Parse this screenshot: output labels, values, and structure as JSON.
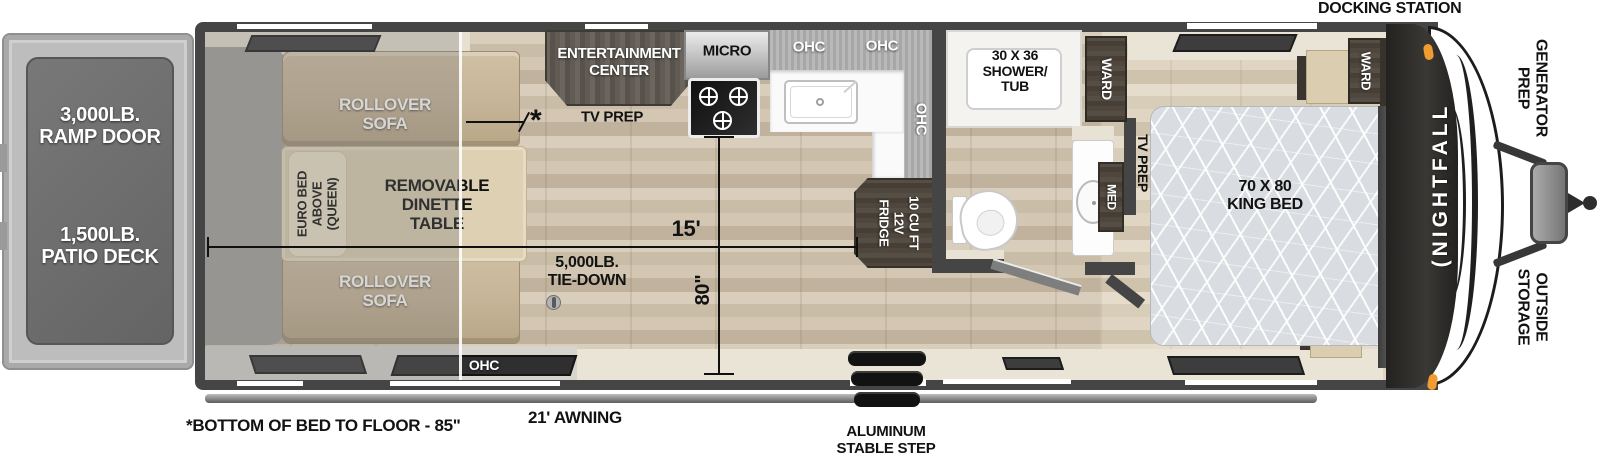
{
  "colors": {
    "wall": "#454545",
    "floor_wood": "#cfc4b0",
    "cabinet_dark": "#57524a",
    "sofa_tan": "#c6b497",
    "marker_amber": "#f29b30",
    "cream": "#e9e4d6"
  },
  "exterior": {
    "docking_station": "DOCKING STATION",
    "generator_prep": [
      "GENERATOR",
      "PREP"
    ],
    "outside_storage": [
      "OUTSIDE",
      "STORAGE"
    ],
    "brand_mark": "(",
    "brand": "NIGHTFALL",
    "awning": "21' AWNING",
    "step": [
      "ALUMINUM",
      "STABLE STEP"
    ],
    "bed_height_note": "*BOTTOM OF BED TO FLOOR - 85\""
  },
  "ramp": {
    "ramp_door": [
      "3,000LB.",
      "RAMP DOOR"
    ],
    "patio_deck": [
      "1,500LB.",
      "PATIO DECK"
    ]
  },
  "garage": {
    "sofa_top": [
      "ROLLOVER",
      "SOFA"
    ],
    "sofa_bottom": [
      "ROLLOVER",
      "SOFA"
    ],
    "euro_bed": [
      "EURO BED",
      "ABOVE",
      "(QUEEN)"
    ],
    "dinette": [
      "REMOVABLE",
      "DINETTE",
      "TABLE"
    ],
    "tie_down": [
      "5,000LB.",
      "TIE-DOWN"
    ],
    "ohc": "OHC"
  },
  "kitchen": {
    "entertainment_center": [
      "ENTERTAINMENT",
      "CENTER"
    ],
    "tv_prep": "TV PREP",
    "micro": "MICRO",
    "ohc_left": "OHC",
    "ohc_right": "OHC",
    "ohc_side": "OHC",
    "fridge": [
      "10 CU FT",
      "12V",
      "FRIDGE"
    ]
  },
  "bath": {
    "shower": [
      "30 X 36",
      "SHOWER/",
      "TUB"
    ],
    "ward": "WARD",
    "med": "MED"
  },
  "bedroom": {
    "tv_prep": "TV PREP",
    "bed": [
      "70 X 80",
      "KING BED"
    ],
    "ward": "WARD",
    "ohc": "OHC"
  },
  "dimensions": {
    "length": "15'",
    "width": "80\"",
    "asterisk": "*"
  }
}
